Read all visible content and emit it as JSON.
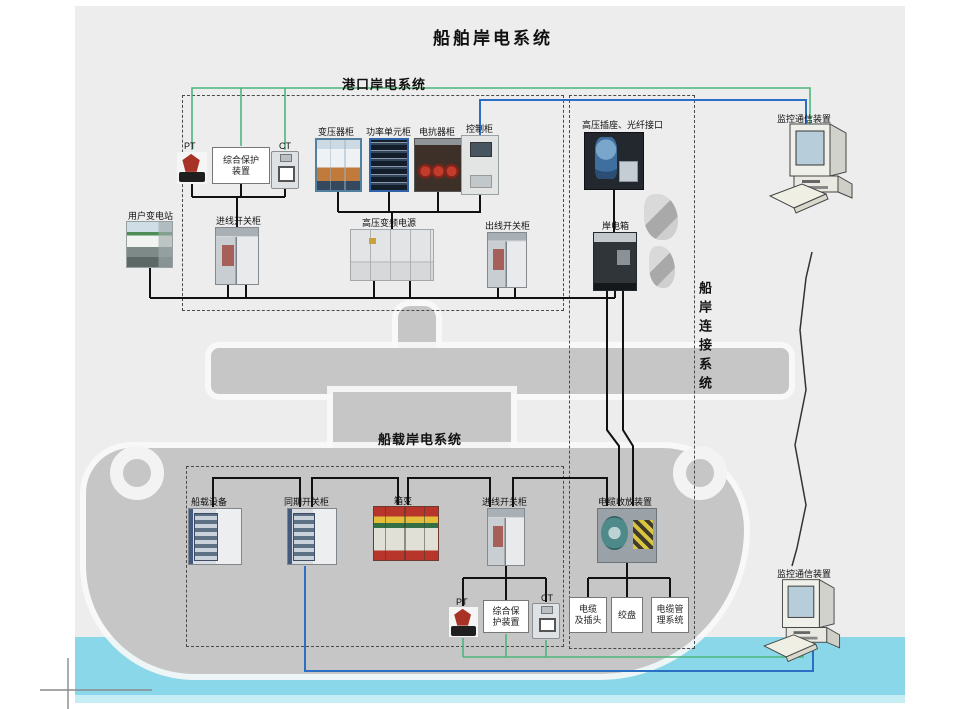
{
  "title": "船舶岸电系统",
  "colors": {
    "green_line": "#4cb57c",
    "blue_line": "#2a6fc4",
    "black_line": "#111111",
    "cable_line": "#333333",
    "cursor_gray": "#8a8a8a",
    "water": "#8bd7ea",
    "ship_gray": "#c6c6c6",
    "panel_bg": "#ededed"
  },
  "port_system": {
    "title": "港口岸电系统",
    "pt": "PT",
    "ct": "CT",
    "protection_l1": "综合保护",
    "protection_l2": "装置",
    "transformer_cabinet": "变压器柜",
    "power_unit_cabinet": "功率单元柜",
    "reactor_cabinet": "电抗器柜",
    "control_cabinet": "控制柜",
    "user_substation": "用户变电站",
    "incoming_switch_cabinet": "进线开关柜",
    "hv_vfd_power": "高压变频电源",
    "outgoing_switch_cabinet": "出线开关柜"
  },
  "connection_system": {
    "title": "船岸连接系统",
    "hv_socket_fiber": "高压插座、光纤接口",
    "shore_power_box": "岸电箱"
  },
  "ship_system": {
    "title": "船载岸电系统",
    "shipboard_equipment": "船载设备",
    "sync_switch_cabinet": "同期开关柜",
    "box_transformer": "箱变",
    "incoming_switch_cabinet": "进线开关柜",
    "cable_reel_device": "电缆收放装置",
    "pt": "PT",
    "ct": "CT",
    "protection_l1": "综合保",
    "protection_l2": "护装置",
    "cable_plug_l1": "电缆",
    "cable_plug_l2": "及插头",
    "winch": "绞盘",
    "cable_mgmt_l1": "电缆管",
    "cable_mgmt_l2": "理系统"
  },
  "monitoring": {
    "top_device": "监控通信装置",
    "bottom_device": "监控通信装置"
  }
}
